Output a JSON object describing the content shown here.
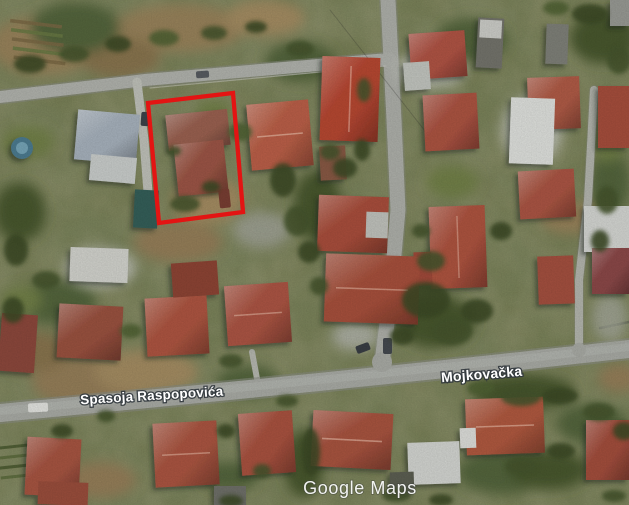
{
  "map": {
    "street_labels": [
      {
        "name": "Spasoja Raspopovića"
      },
      {
        "name": "Mojkovačka"
      }
    ],
    "watermark": "Google Maps",
    "annotation": {
      "description": "red rectangle outlining highlighted parcel",
      "color": "#e31413",
      "polygon_points": "148,103 233,93 243,212 159,223"
    },
    "colors": {
      "annotation_red": "#e31413",
      "road_gray": "#abada7",
      "vegetation_green": "#5e6e40",
      "roof_terracotta": "#b05742",
      "roof_bright_red": "#b94833"
    }
  }
}
